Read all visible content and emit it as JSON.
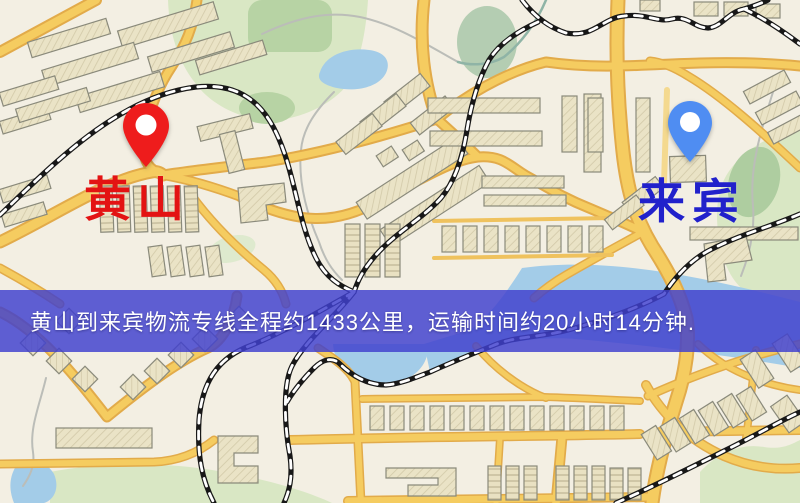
{
  "map": {
    "origin": {
      "name": "黄山",
      "pin_color": "#EE1C1C",
      "label_color": "#E31313",
      "pin_icon": "red-map-pin-icon"
    },
    "destination": {
      "name": "来宾",
      "pin_color": "#4F8DF2",
      "label_color": "#2121CB",
      "pin_icon": "blue-map-pin-icon"
    }
  },
  "banner": {
    "text": "黄山到来宾物流专线全程约1433公里，运输时间约20小时14分钟.",
    "route": {
      "from": "黄山",
      "to": "来宾",
      "distance_km": "1433",
      "duration": "20小时14分钟"
    },
    "background_color": "#4040CE",
    "text_color": "#FFFFFF"
  },
  "palette": {
    "map_background": "#F3EFE3",
    "road_fill": "#F5CC60",
    "road_casing": "#E2AB4A",
    "minor_road": "#F4D98F",
    "water": "#A3CCE8",
    "park_green": "#D9E7C4",
    "dark_green": "#9FC2A2",
    "railway": "#181818",
    "building_fill": "#EAE3C6",
    "building_outline": "#8A8A7B"
  }
}
